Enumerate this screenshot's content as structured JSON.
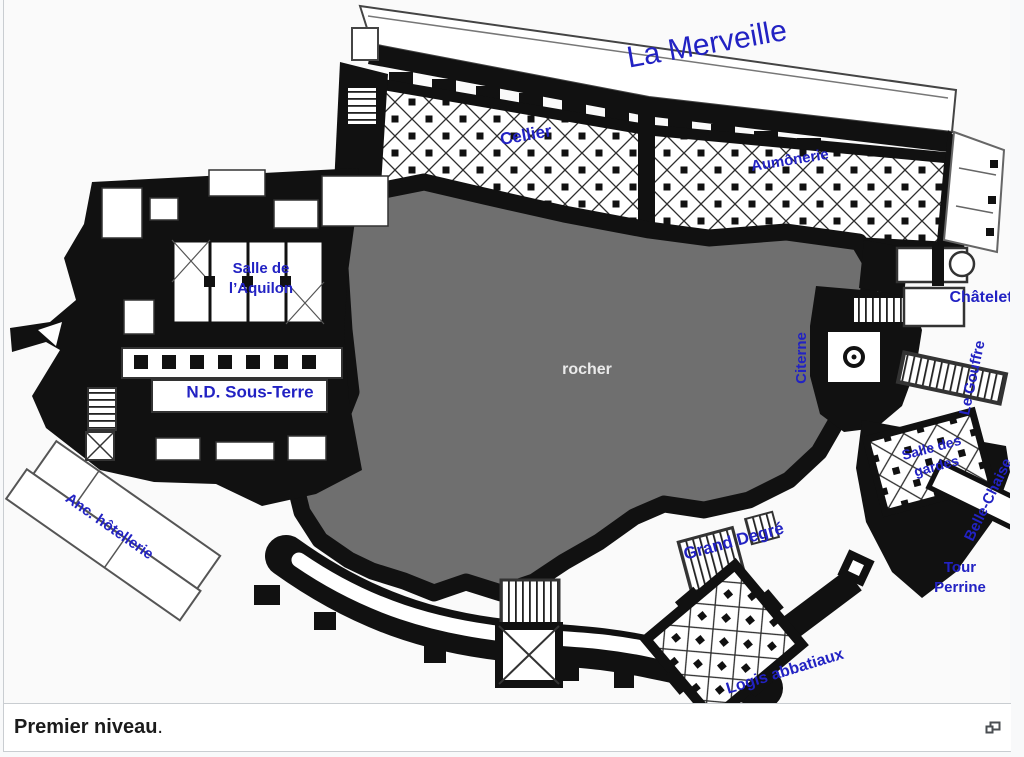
{
  "figure": {
    "caption": {
      "bold_text": "Premier niveau",
      "suffix": "."
    }
  },
  "plan": {
    "colors": {
      "label_blue": "#2222c3",
      "rock_gray": "#6f6f6f",
      "wall_black": "#111111",
      "rocher_text": "#ebebeb"
    },
    "labels": [
      {
        "id": "la-merveille",
        "text": "La Merveille",
        "x": 703,
        "y": 45,
        "rot": -10,
        "size": 30,
        "weight": "normal"
      },
      {
        "id": "cellier",
        "text": "Cellier",
        "x": 522,
        "y": 136,
        "rot": -10,
        "size": 17
      },
      {
        "id": "aumonerie",
        "text": "Aumônerie",
        "x": 786,
        "y": 161,
        "rot": -9,
        "size": 15
      },
      {
        "id": "salle-aquilon",
        "lines": [
          "Salle de",
          "l’Aquilon"
        ],
        "x": 257,
        "y": 279,
        "rot": 0,
        "size": 15
      },
      {
        "id": "nd-sous-terre",
        "text": "N.D. Sous-Terre",
        "x": 246,
        "y": 393,
        "rot": 0,
        "size": 17
      },
      {
        "id": "rocher",
        "text": "rocher",
        "x": 583,
        "y": 370,
        "rot": 0,
        "size": 16,
        "color": "#ebebeb"
      },
      {
        "id": "citerne",
        "text": "Citerne",
        "x": 798,
        "y": 358,
        "rot": -90,
        "size": 15
      },
      {
        "id": "chatelet",
        "text": "Châtelet",
        "x": 977,
        "y": 298,
        "rot": 0,
        "size": 16
      },
      {
        "id": "le-gouffre",
        "text": "Le Gouffre",
        "x": 969,
        "y": 378,
        "rot": -78,
        "size": 15
      },
      {
        "id": "salle-des-gardes",
        "lines": [
          "Salle des",
          "gardes"
        ],
        "x": 930,
        "y": 457,
        "rot": -15,
        "size": 14
      },
      {
        "id": "belle-chaise",
        "text": "Belle-Chaise",
        "x": 985,
        "y": 500,
        "rot": -64,
        "size": 15
      },
      {
        "id": "tour-perrine",
        "lines": [
          "Tour",
          "Perrine"
        ],
        "x": 956,
        "y": 578,
        "rot": 0,
        "size": 15
      },
      {
        "id": "grand-degre",
        "text": "Grand Degré",
        "x": 730,
        "y": 542,
        "rot": -15,
        "size": 17
      },
      {
        "id": "logis-abbatiaux",
        "text": "Logis abbatiaux",
        "x": 781,
        "y": 672,
        "rot": -17,
        "size": 16
      },
      {
        "id": "anc-hotellerie",
        "text": "Anc. hôtellerie",
        "x": 105,
        "y": 527,
        "rot": 35,
        "size": 15
      }
    ]
  }
}
